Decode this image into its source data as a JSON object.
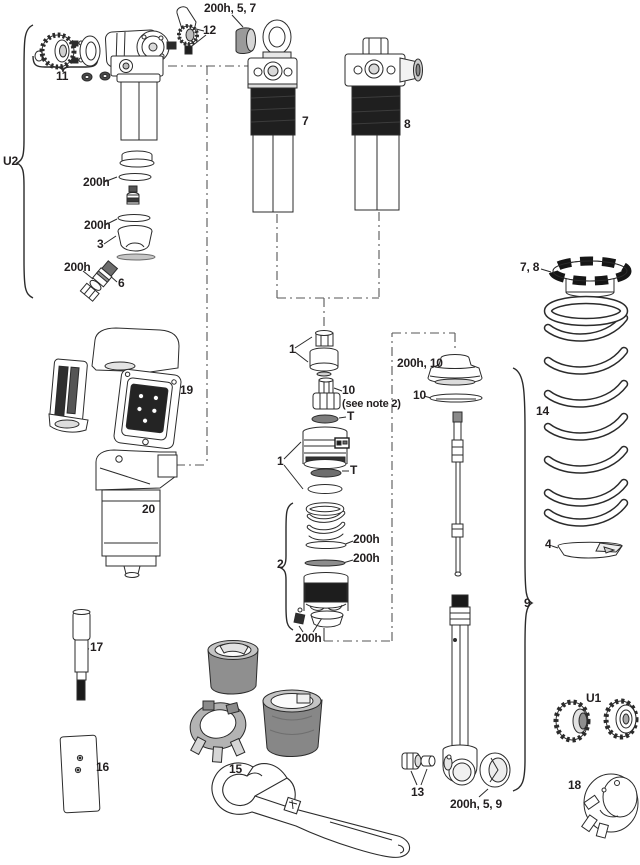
{
  "diagram": {
    "type": "exploded-parts-diagram",
    "colors": {
      "ink": "#2b2b2b",
      "band": "#1f1f1f",
      "gray": "#9e9e9e",
      "background": "#ffffff"
    },
    "labels": [
      {
        "text": "200h, 5, 7"
      },
      {
        "text": "12"
      },
      {
        "text": "11"
      },
      {
        "text": "U2"
      },
      {
        "text": "200h"
      },
      {
        "text": "200h"
      },
      {
        "text": "3"
      },
      {
        "text": "200h"
      },
      {
        "text": "6"
      },
      {
        "text": "7"
      },
      {
        "text": "8"
      },
      {
        "text": "7, 8"
      },
      {
        "text": "14"
      },
      {
        "text": "4"
      },
      {
        "text": "1"
      },
      {
        "text": "10"
      },
      {
        "text": "(see note 2)"
      },
      {
        "text": "T"
      },
      {
        "text": "1"
      },
      {
        "text": "T"
      },
      {
        "text": "200h, 10"
      },
      {
        "text": "10"
      },
      {
        "text": "2"
      },
      {
        "text": "200h"
      },
      {
        "text": "200h"
      },
      {
        "text": "200h"
      },
      {
        "text": "19"
      },
      {
        "text": "20"
      },
      {
        "text": "17"
      },
      {
        "text": "16"
      },
      {
        "text": "15"
      },
      {
        "text": "9"
      },
      {
        "text": "13"
      },
      {
        "text": "200h, 5, 9"
      },
      {
        "text": "U1"
      },
      {
        "text": "18"
      }
    ]
  }
}
